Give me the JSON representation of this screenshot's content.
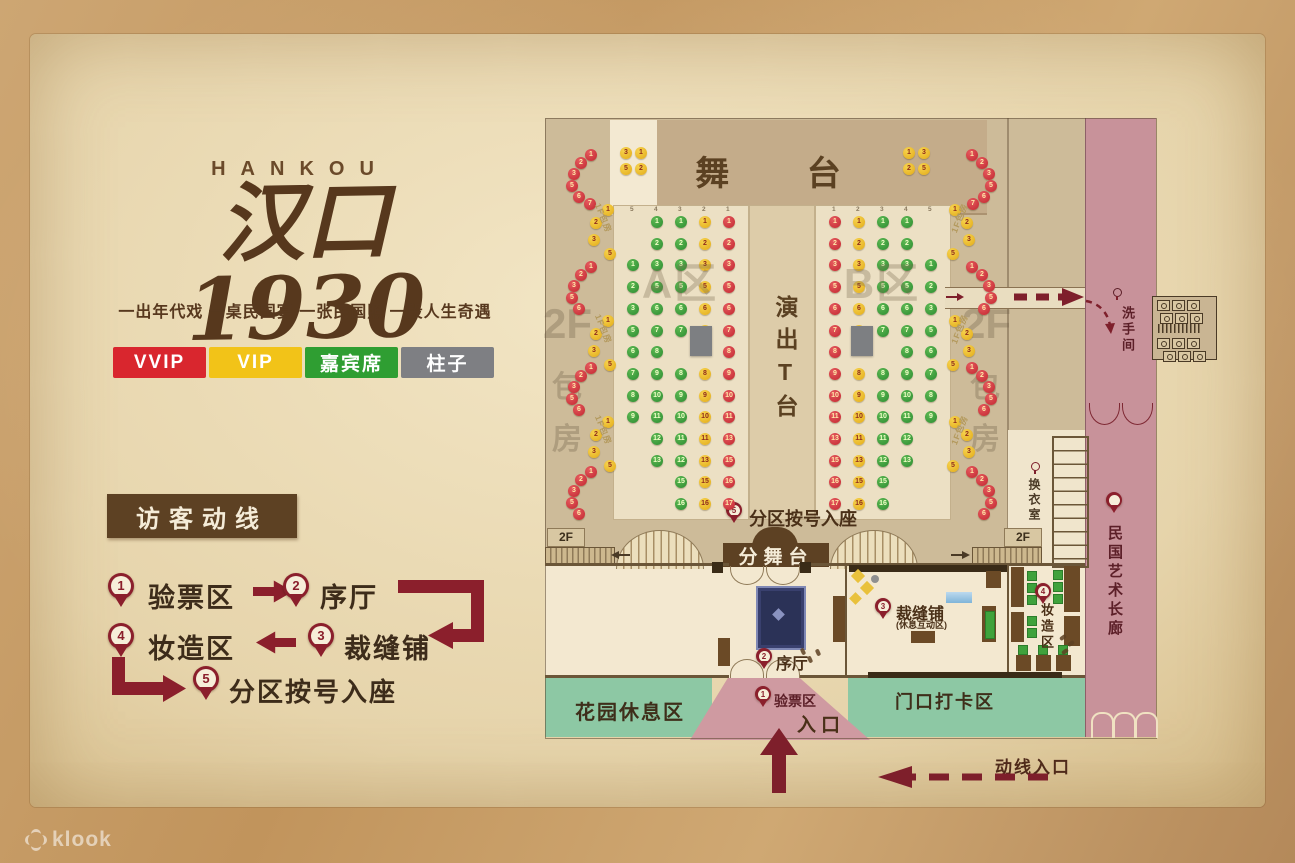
{
  "brand": {
    "latin": "HANKOU",
    "name": "汉口1930",
    "tagline": "一出年代戏 一桌民国宴 一张民国照 一段人生奇遇"
  },
  "legend": [
    {
      "label": "VVIP",
      "color": "#d9262e"
    },
    {
      "label": "VIP",
      "color": "#f2c318"
    },
    {
      "label": "嘉宾席",
      "color": "#2f9e32"
    },
    {
      "label": "柱子",
      "color": "#7e7f83"
    }
  ],
  "flow": {
    "title": "访客动线",
    "steps": [
      {
        "num": "1",
        "label": "验票区"
      },
      {
        "num": "2",
        "label": "序厅"
      },
      {
        "num": "3",
        "label": "裁缝铺"
      },
      {
        "num": "4",
        "label": "妆造区"
      },
      {
        "num": "5",
        "label": "分区按号入座"
      }
    ]
  },
  "map": {
    "labels": {
      "stage": "舞 台",
      "runway": "演出T台",
      "substage": "分舞台",
      "garden": "花园休息区",
      "photo": "门口打卡区",
      "entrance": "入口",
      "corridor": "民国艺术长廊",
      "restroom": "洗手间",
      "changing": "换衣室",
      "flowEntry": "动线入口",
      "floor2": "2F",
      "bao": "包",
      "fang": "房",
      "booth1f": "1F包房",
      "tailorSub": "(休息互动区)"
    },
    "pins": {
      "checkin": {
        "num": "1",
        "label": "验票区"
      },
      "foyer": {
        "num": "2",
        "label": "序厅"
      },
      "tailor": {
        "num": "3",
        "label": "裁缝铺"
      },
      "makeup": {
        "num": "4",
        "label": "妆造区"
      },
      "seated": {
        "num": "5",
        "label": "分区按号入座"
      }
    },
    "seatColors": {
      "red": "#c52831",
      "yellow": "#eab31e",
      "green": "#2f9233",
      "pillar": "#7d7f82"
    },
    "flowColor": "#8b1f2c",
    "blocks": [
      {
        "name": "A区",
        "x": 613,
        "w": 134,
        "headers": [
          "5",
          "4",
          "3",
          "2",
          "1"
        ],
        "cols": [
          {
            "x": 627,
            "color": "green",
            "seats": [
              null,
              null,
              1,
              2,
              3,
              5,
              6,
              7,
              8,
              9,
              null,
              null,
              null,
              null
            ]
          },
          {
            "x": 651,
            "color": "green",
            "seats": [
              1,
              2,
              3,
              5,
              6,
              7,
              8,
              9,
              10,
              11,
              12,
              13,
              null,
              null
            ]
          },
          {
            "x": 675,
            "color": "green",
            "seats": [
              1,
              2,
              3,
              5,
              6,
              7,
              null,
              8,
              9,
              10,
              11,
              12,
              15,
              16
            ]
          },
          {
            "x": 699,
            "color": "yellow",
            "seats": [
              1,
              2,
              3,
              5,
              6,
              7,
              null,
              8,
              9,
              10,
              11,
              13,
              15,
              16
            ]
          },
          {
            "x": 723,
            "color": "red",
            "seats": [
              1,
              2,
              3,
              5,
              6,
              7,
              8,
              9,
              10,
              11,
              13,
              15,
              16,
              17
            ]
          }
        ],
        "pillar": {
          "x": 690,
          "y": 326,
          "w": 22,
          "h": 30
        }
      },
      {
        "name": "B区",
        "x": 815,
        "w": 134,
        "headers": [
          "1",
          "2",
          "3",
          "4",
          "5"
        ],
        "cols": [
          {
            "x": 829,
            "color": "red",
            "seats": [
              1,
              2,
              3,
              5,
              6,
              7,
              8,
              9,
              10,
              11,
              13,
              15,
              16,
              17
            ]
          },
          {
            "x": 853,
            "color": "yellow",
            "seats": [
              1,
              2,
              3,
              5,
              6,
              7,
              null,
              8,
              9,
              10,
              11,
              13,
              15,
              16
            ]
          },
          {
            "x": 877,
            "color": "green",
            "seats": [
              1,
              2,
              3,
              5,
              6,
              7,
              null,
              8,
              9,
              10,
              11,
              12,
              15,
              16
            ]
          },
          {
            "x": 901,
            "color": "green",
            "seats": [
              1,
              2,
              3,
              5,
              6,
              7,
              8,
              9,
              10,
              11,
              12,
              13,
              null,
              null
            ]
          },
          {
            "x": 925,
            "color": "green",
            "seats": [
              null,
              null,
              1,
              2,
              3,
              5,
              6,
              7,
              8,
              9,
              null,
              null,
              null,
              null
            ]
          }
        ],
        "pillar": {
          "x": 851,
          "y": 326,
          "w": 22,
          "h": 30
        }
      }
    ],
    "stageTables": {
      "left": {
        "x": 620,
        "y": 147,
        "values": [
          [
            3,
            1
          ],
          [
            5,
            2
          ]
        ]
      },
      "right": {
        "x": 903,
        "y": 147,
        "values": [
          [
            1,
            3
          ],
          [
            2,
            5
          ]
        ]
      }
    },
    "sideStrips": {
      "left": {
        "clusters": [
          {
            "type": "red",
            "y": 149,
            "seats": [
              1,
              2,
              3,
              5,
              6,
              7
            ]
          },
          {
            "type": "yellow",
            "y": 204,
            "seats": [
              1,
              2,
              3,
              5
            ],
            "label": "1F包房"
          },
          {
            "type": "red",
            "y": 261,
            "seats": [
              1,
              2,
              3,
              5,
              6
            ]
          },
          {
            "type": "yellow",
            "y": 315,
            "seats": [
              1,
              2,
              3,
              5
            ],
            "label": "1F包房"
          },
          {
            "type": "red",
            "y": 362,
            "seats": [
              1,
              2,
              3,
              5,
              6
            ]
          },
          {
            "type": "yellow",
            "y": 416,
            "seats": [
              1,
              2,
              3,
              5
            ],
            "label": "1F包房"
          },
          {
            "type": "red",
            "y": 466,
            "seats": [
              1,
              2,
              3,
              5,
              6
            ]
          }
        ]
      },
      "right": {
        "clusters": [
          {
            "type": "red",
            "y": 149,
            "seats": [
              1,
              2,
              3,
              5,
              6,
              7
            ]
          },
          {
            "type": "yellow",
            "y": 204,
            "seats": [
              1,
              2,
              3,
              5
            ],
            "label": "1F包房"
          },
          {
            "type": "red",
            "y": 261,
            "seats": [
              1,
              2,
              3,
              5,
              6
            ]
          },
          {
            "type": "yellow",
            "y": 315,
            "seats": [
              1,
              2,
              3,
              5
            ],
            "label": "1F包房"
          },
          {
            "type": "red",
            "y": 362,
            "seats": [
              1,
              2,
              3,
              5,
              6
            ]
          },
          {
            "type": "yellow",
            "y": 416,
            "seats": [
              1,
              2,
              3,
              5
            ],
            "label": "1F包房"
          },
          {
            "type": "red",
            "y": 466,
            "seats": [
              1,
              2,
              3,
              5,
              6
            ]
          }
        ]
      }
    }
  },
  "watermark": "klook"
}
